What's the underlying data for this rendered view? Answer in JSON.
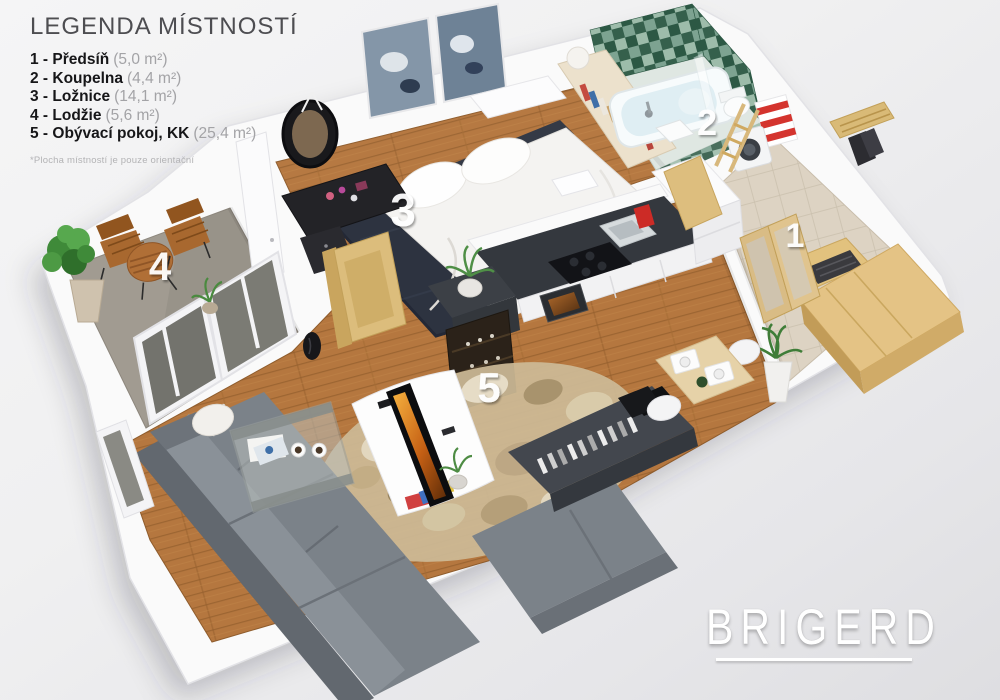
{
  "legend": {
    "title": "LEGENDA MÍSTNOSTÍ",
    "items": [
      {
        "label": "1 - Předsíň",
        "area": "(5,0 m²)"
      },
      {
        "label": "2 - Koupelna",
        "area": "(4,4 m²)"
      },
      {
        "label": "3 - Ložnice",
        "area": "(14,1 m²)"
      },
      {
        "label": "4 - Lodžie",
        "area": "(5,6 m²)"
      },
      {
        "label": "5 - Obývací pokoj, KK",
        "area": "(25,4 m²)"
      }
    ],
    "footnote": "*Plocha místností je pouze orientační"
  },
  "floorplan": {
    "labels": [
      "1",
      "2",
      "3",
      "4",
      "5"
    ]
  },
  "logo": {
    "text": "BRIGERD"
  },
  "colors": {
    "background": "#efeff1",
    "wall": "#fafafa",
    "wood_floor": "#b5773f",
    "hall_floor": "#ddd3c3",
    "loggia_floor": "#a19b91",
    "bath_tile_dark": "#35604c",
    "bath_tile_light": "#7da391",
    "sofa_gray": "#7b8289",
    "bedroom_rug": "#2d3340",
    "living_rug": "#cdbb97",
    "wood_furniture": "#ddbe7c",
    "accent_red": "#cc2b26",
    "room_label_text": "#ffffff",
    "logo_text": "#ffffff"
  }
}
